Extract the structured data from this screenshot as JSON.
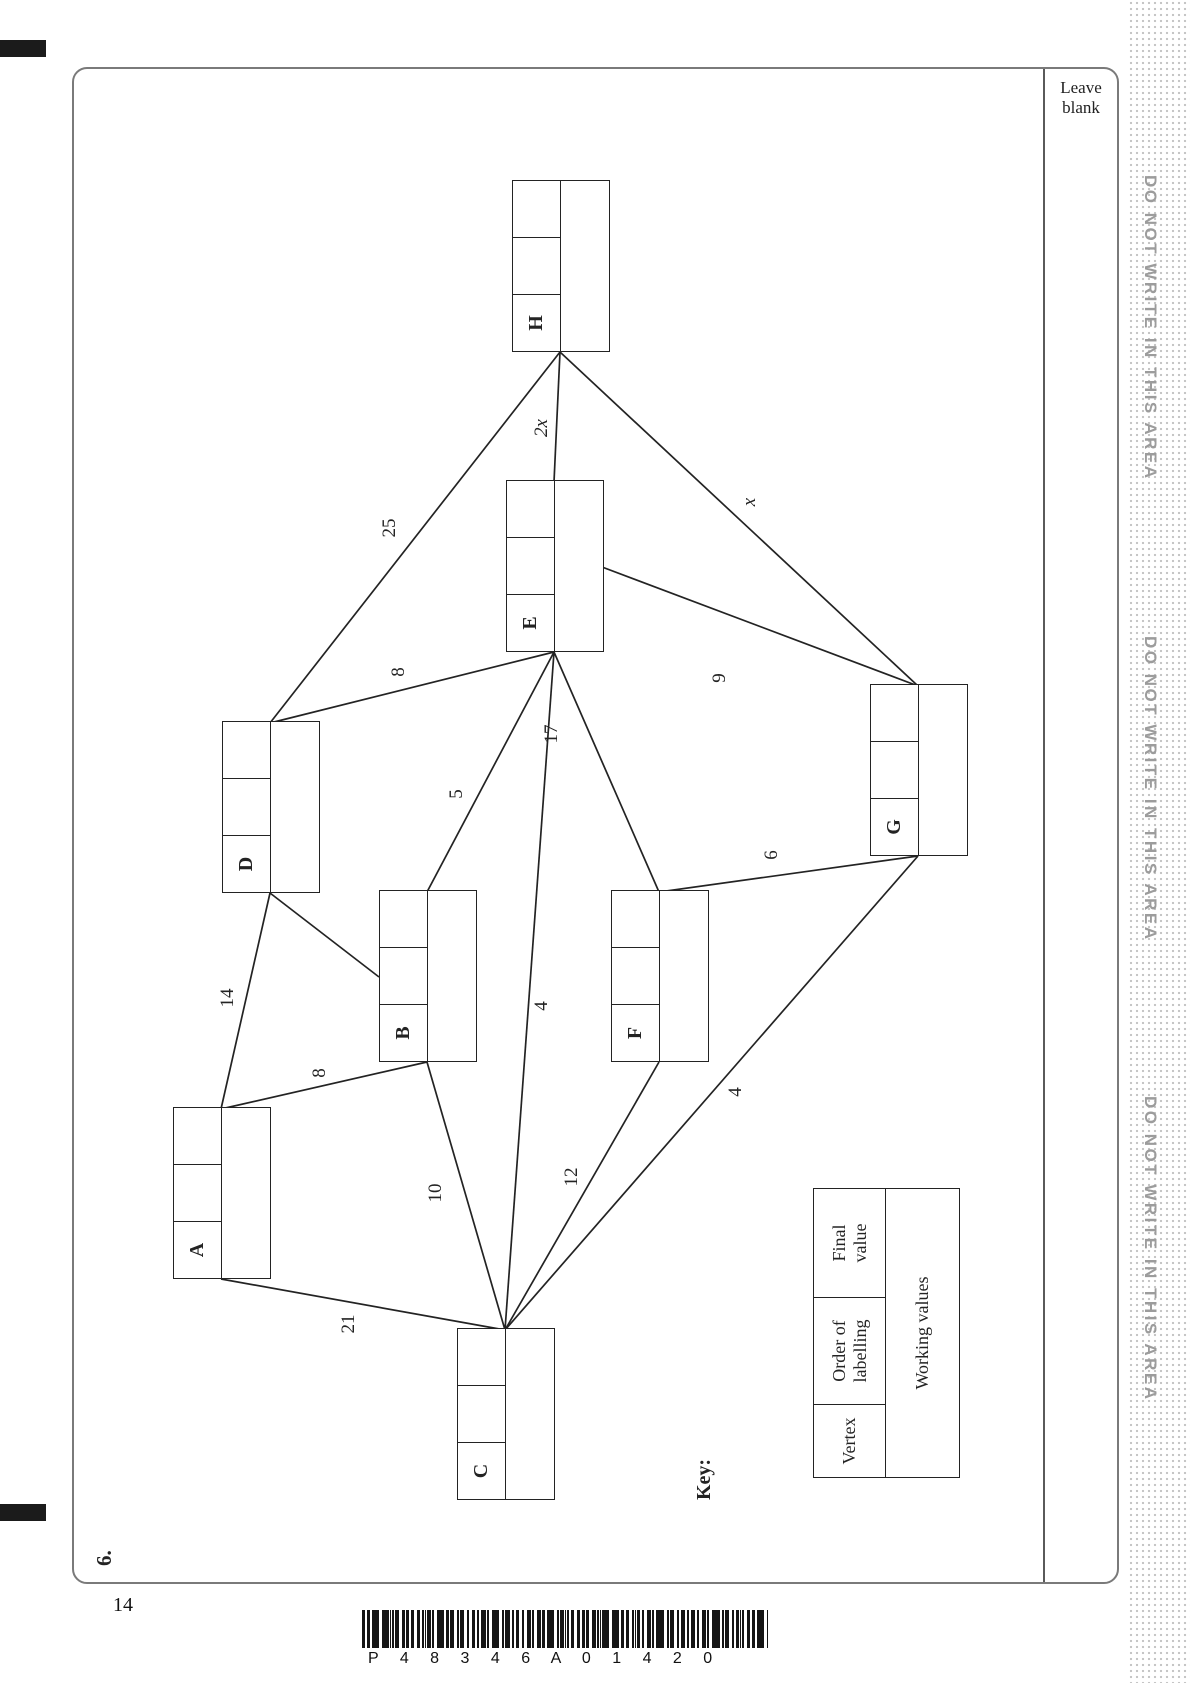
{
  "page": {
    "question_number": "6.",
    "leave_blank": "Leave\nblank",
    "margin_text": "DO NOT WRITE IN THIS AREA",
    "page_number": "14",
    "barcode_text": "P 4 8 3 4 6 A 0 1 4 2 0"
  },
  "key": {
    "title": "Key:",
    "vertex": "Vertex",
    "order": "Order of\nlabelling",
    "final": "Final\nvalue",
    "working": "Working values"
  },
  "graph": {
    "description": "Network for Dijkstra's algorithm: vertices with labelling boxes (vertex, order of labelling, final value, working values) and weighted edges",
    "vertices": [
      {
        "id": "A",
        "x": 301,
        "y": 101
      },
      {
        "id": "B",
        "x": 518,
        "y": 307
      },
      {
        "id": "C",
        "x": 80,
        "y": 385
      },
      {
        "id": "D",
        "x": 687,
        "y": 150
      },
      {
        "id": "E",
        "x": 928,
        "y": 434
      },
      {
        "id": "F",
        "x": 518,
        "y": 539
      },
      {
        "id": "G",
        "x": 724,
        "y": 798
      },
      {
        "id": "H",
        "x": 1228,
        "y": 440
      }
    ],
    "edges": [
      {
        "from": "A",
        "fromSide": "right",
        "to": "D",
        "toSide": "left",
        "weight": "14",
        "labelX": 582,
        "labelY": 156,
        "italic": false
      },
      {
        "from": "A",
        "fromSide": "right",
        "to": "B",
        "toSide": "left",
        "weight": "8",
        "labelX": 507,
        "labelY": 248,
        "italic": false
      },
      {
        "from": "A",
        "fromSide": "left",
        "to": "C",
        "toSide": "right",
        "weight": "21",
        "labelX": 256,
        "labelY": 277,
        "italic": false
      },
      {
        "from": "B",
        "fromSide": "top",
        "to": "D",
        "toSide": "left",
        "weight": "4",
        "labelX": 694,
        "labelY": 224,
        "italic": false
      },
      {
        "from": "B",
        "fromSide": "left",
        "to": "C",
        "toSide": "right",
        "weight": "10",
        "labelX": 387,
        "labelY": 364,
        "italic": false
      },
      {
        "from": "B",
        "fromSide": "right",
        "to": "E",
        "toSide": "left",
        "weight": "5",
        "labelX": 786,
        "labelY": 385,
        "italic": false
      },
      {
        "from": "C",
        "fromSide": "right",
        "to": "E",
        "toSide": "left",
        "weight": "4",
        "labelX": 574,
        "labelY": 470,
        "italic": false
      },
      {
        "from": "C",
        "fromSide": "right",
        "to": "F",
        "toSide": "left",
        "weight": "12",
        "labelX": 403,
        "labelY": 500,
        "italic": false
      },
      {
        "from": "C",
        "fromSide": "right",
        "to": "G",
        "toSide": "left",
        "weight": "4",
        "labelX": 488,
        "labelY": 664,
        "italic": false
      },
      {
        "from": "D",
        "fromSide": "right",
        "to": "E",
        "toSide": "left",
        "weight": "8",
        "labelX": 908,
        "labelY": 327,
        "italic": false
      },
      {
        "from": "D",
        "fromSide": "right",
        "to": "H",
        "toSide": "left",
        "weight": "25",
        "labelX": 1052,
        "labelY": 318,
        "italic": false
      },
      {
        "from": "E",
        "fromSide": "left",
        "to": "F",
        "toSide": "right",
        "weight": "17",
        "labelX": 846,
        "labelY": 480,
        "italic": false
      },
      {
        "from": "E",
        "fromSide": "bottom",
        "to": "G",
        "toSide": "right",
        "weight": "9",
        "labelX": 902,
        "labelY": 648,
        "italic": false
      },
      {
        "from": "E",
        "fromSide": "right",
        "to": "H",
        "toSide": "left",
        "weight": "2x",
        "labelX": 1152,
        "labelY": 470,
        "italic": true
      },
      {
        "from": "F",
        "fromSide": "right",
        "to": "G",
        "toSide": "left",
        "weight": "6",
        "labelX": 725,
        "labelY": 700,
        "italic": false
      },
      {
        "from": "G",
        "fromSide": "right",
        "to": "H",
        "toSide": "left",
        "weight": "x",
        "labelX": 1078,
        "labelY": 678,
        "italic": true
      }
    ]
  },
  "colors": {
    "ink": "#232323",
    "frame": "#7a7a7a",
    "muted": "#9c9c9c",
    "dots": "#c6c6c6"
  }
}
